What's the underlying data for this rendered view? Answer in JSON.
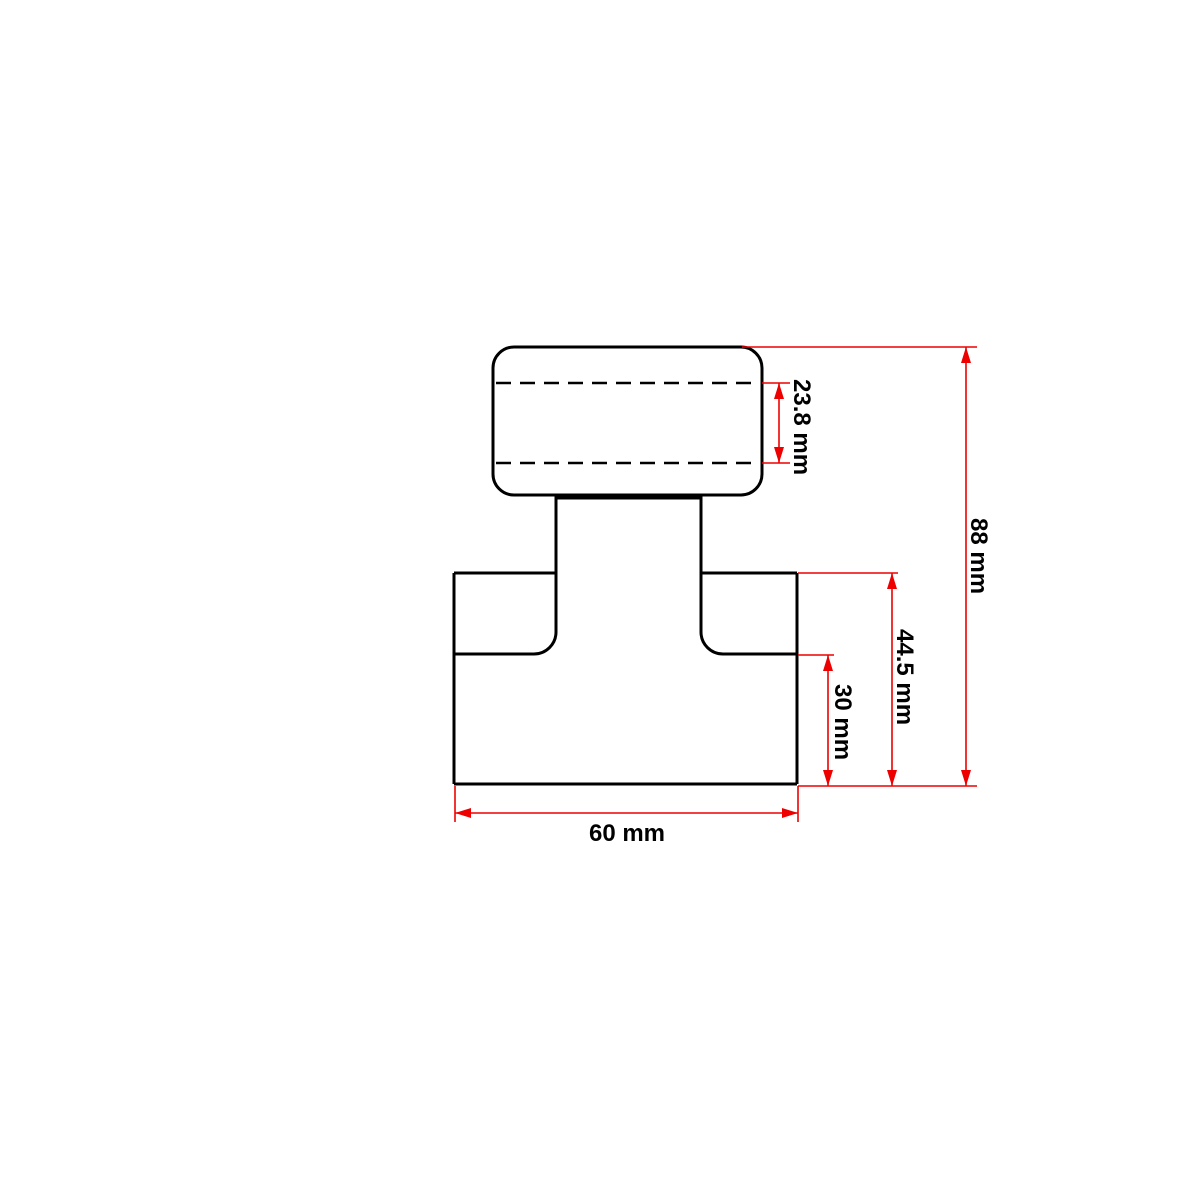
{
  "drawing": {
    "colors": {
      "background": "#ffffff",
      "outline": "#000000",
      "dimension": "#ee0000",
      "text": "#000000"
    },
    "dimensions": {
      "knob_section_height": {
        "label": "23.8 mm"
      },
      "overall_height": {
        "label": "88 mm"
      },
      "lower_body_height": {
        "label": "44.5 mm"
      },
      "base_height": {
        "label": "30 mm"
      },
      "base_width": {
        "label": "60 mm"
      }
    }
  }
}
